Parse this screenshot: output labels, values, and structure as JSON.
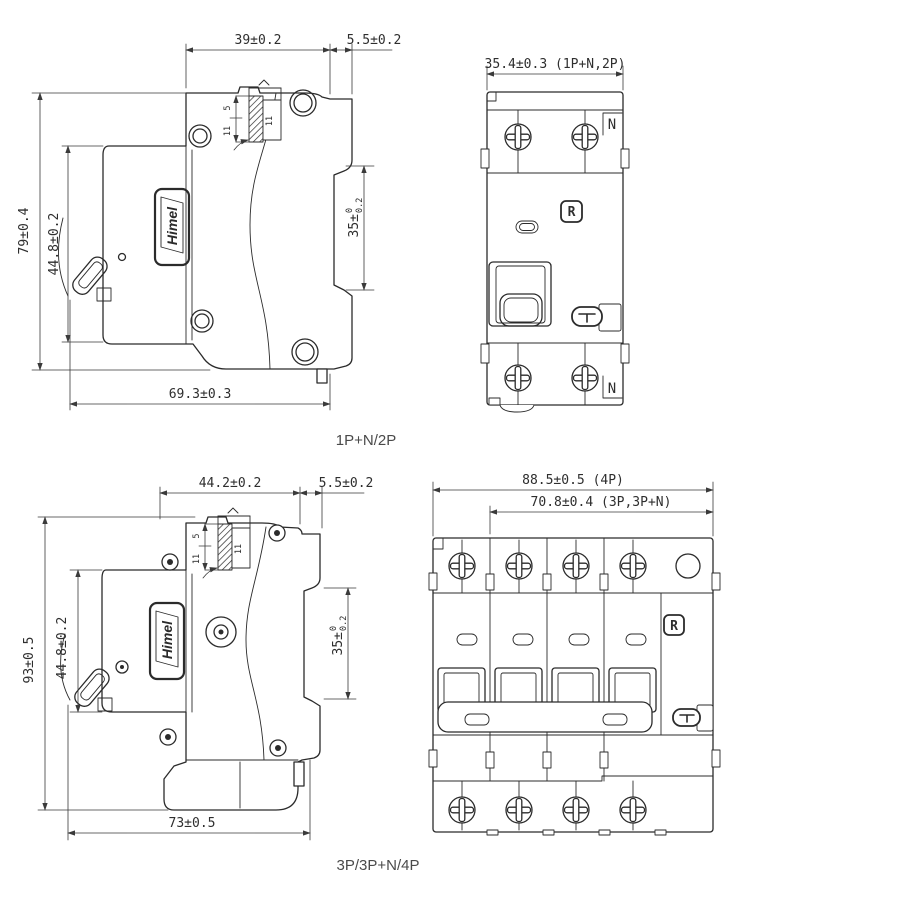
{
  "page": {
    "background": "#ffffff",
    "line_color": "#2b2b2b",
    "text_color": "#2e2e2e"
  },
  "views": {
    "side_2p": {
      "name_label": "1P+N/2P",
      "logo_text": "Himel",
      "dims": {
        "top_width": "39±0.2",
        "rail_depth": "5.5±0.2",
        "overall_height": "79±0.4",
        "body_height": "44.8±0.2",
        "bottom_width": "69.3±0.3",
        "rail_height_base": "35±",
        "rail_height_tol_upper": "0",
        "rail_height_tol_lower": "0.2"
      },
      "rail_detail": {
        "dim_a": "5",
        "dim_b": "11",
        "dim_c": "11"
      }
    },
    "front_2p": {
      "dims": {
        "overall_width": "35.4±0.3 (1P+N,2P)"
      },
      "labels": {
        "neutral_top": "N",
        "neutral_bottom": "N",
        "reset_button": "R"
      }
    },
    "side_4p": {
      "name_label": "3P/3P+N/4P",
      "logo_text": "Himel",
      "dims": {
        "top_width": "44.2±0.2",
        "rail_depth": "5.5±0.2",
        "overall_height": "93±0.5",
        "body_height": "44.8±0.2",
        "bottom_width": "73±0.5",
        "rail_height_base": "35±",
        "rail_height_tol_upper": "0",
        "rail_height_tol_lower": "0.2"
      },
      "rail_detail": {
        "dim_a": "5",
        "dim_b": "11",
        "dim_c": "11"
      }
    },
    "front_4p": {
      "dims": {
        "overall_width_4p": "88.5±0.5 (4P)",
        "width_3p": "70.8±0.4 (3P,3P+N)"
      },
      "labels": {
        "reset_button": "R"
      }
    }
  }
}
